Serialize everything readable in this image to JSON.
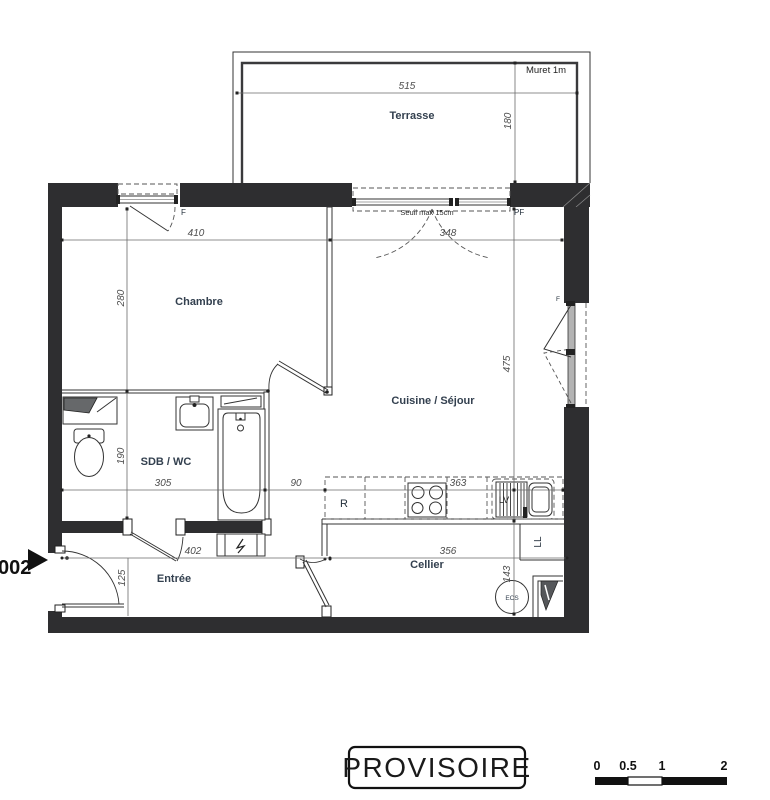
{
  "plan": {
    "unit": "002",
    "rooms": {
      "terrasse": "Terrasse",
      "chambre": "Chambre",
      "cuisine": "Cuisine / Séjour",
      "sdb": "SDB / WC",
      "entree": "Entrée",
      "cellier": "Cellier"
    },
    "annotations": {
      "muret": "Muret 1m",
      "seuil": "Seuil max 15cm",
      "pf": "PF",
      "f_top": "F",
      "f_right": "F",
      "fridge": "R",
      "dishwasher": "LV",
      "washer": "LL",
      "water_heater": "ECS"
    },
    "dims": {
      "terrasse_w": "515",
      "terrasse_d": "180",
      "chambre_w": "410",
      "pf_w": "348",
      "chambre_d": "280",
      "sdb_d": "190",
      "sdb_w": "305",
      "hall_w": "90",
      "cuisine_w": "363",
      "cuisine_d": "475",
      "entree_w": "402",
      "entree_d": "125",
      "cellier_w": "356",
      "cellier_d": "143"
    }
  },
  "stamp": "PROVISOIRE",
  "scalebar": {
    "ticks": [
      "0",
      "0.5",
      "1",
      "2"
    ]
  },
  "colors": {
    "wall": "#2e2e30",
    "room_label": "#33404f",
    "dim_text": "#4d4d4d",
    "accent": "#111111"
  }
}
